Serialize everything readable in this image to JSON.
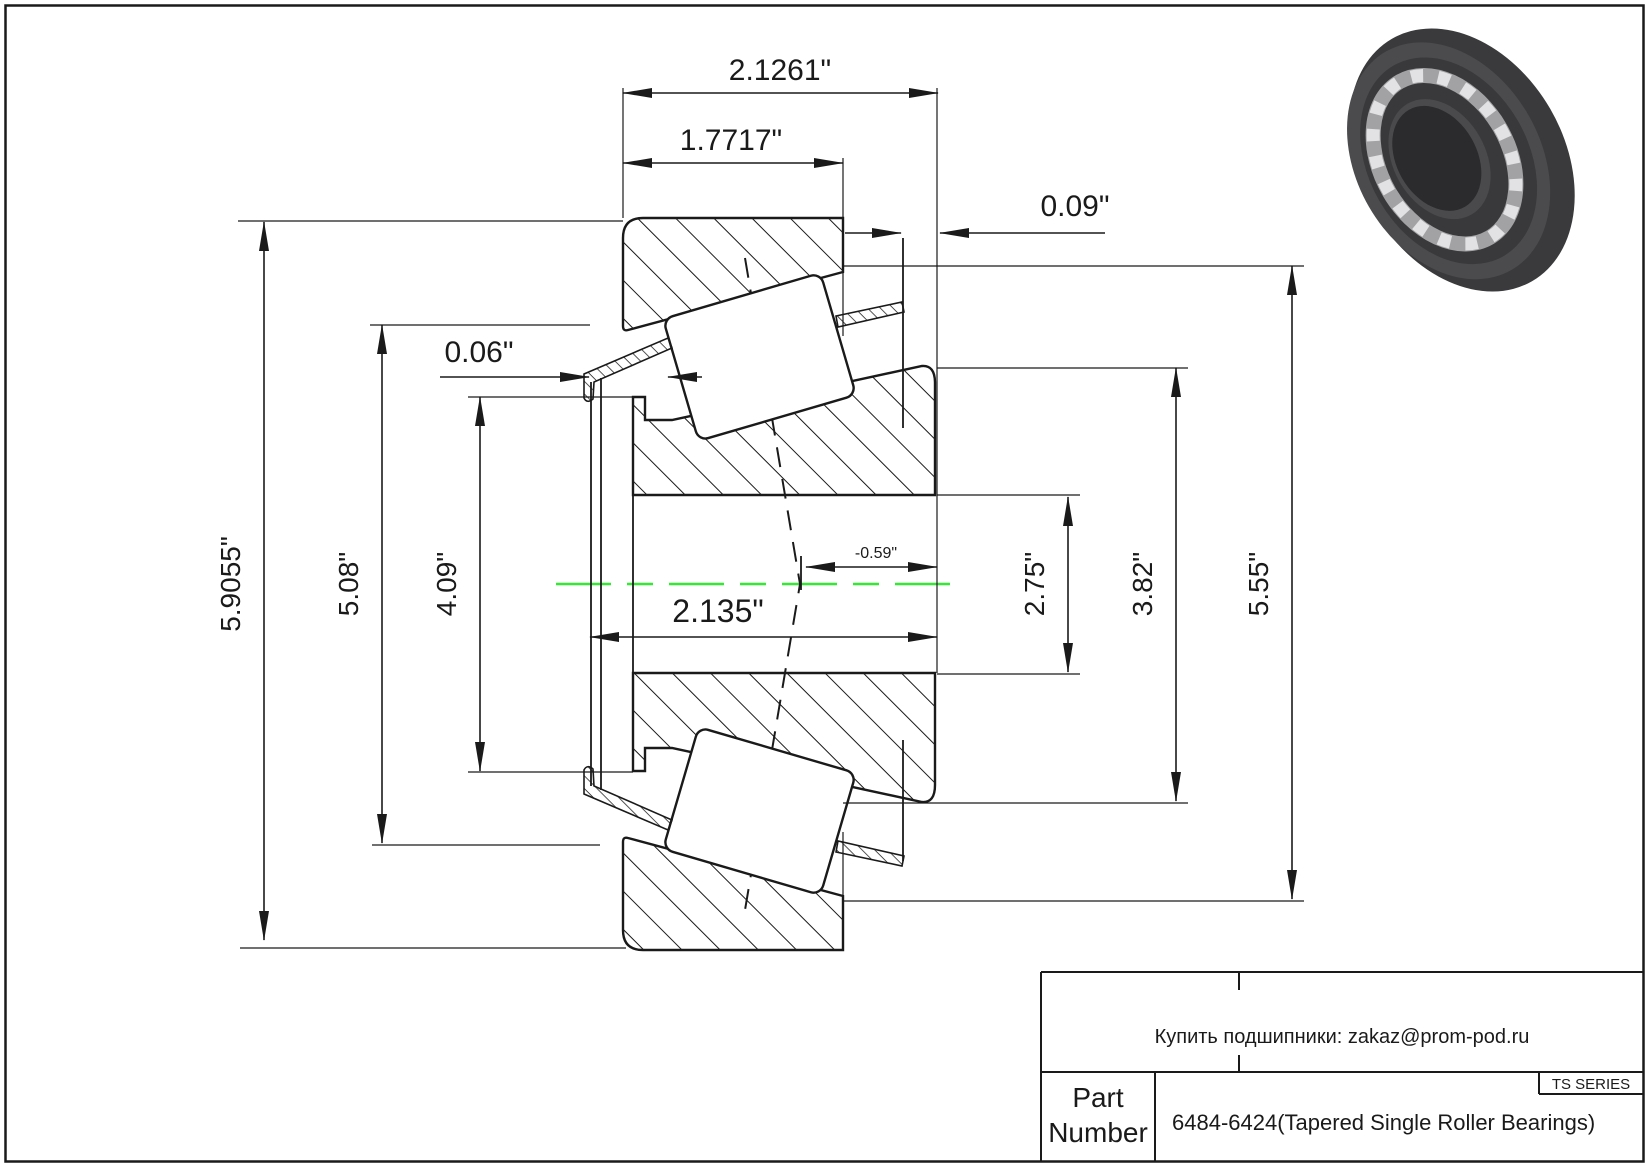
{
  "page": {
    "background": "#ffffff",
    "border_color": "#1a1a1a"
  },
  "colors": {
    "line": "#1a1a1a",
    "center_line_green": "#35e835",
    "bearing_body_dark": "#3a3a3c",
    "bearing_face": "#4b4b4e",
    "bearing_cage": "#a2a2a5",
    "bearing_rollers": "#e2e2e4",
    "bearing_bore": "#2b2b2d"
  },
  "dimensions": {
    "cup_outer_width": "2.1261\"",
    "cone_width": "1.7717\"",
    "back_face_offset": "0.09\"",
    "front_face_offset": "0.06\"",
    "outer_diameter": "5.9055\"",
    "flange_diameter": "5.08\"",
    "front_rib_diameter": "4.09\"",
    "overall_width": "2.135\"",
    "effective_center": "-0.59\"",
    "bore_diameter": "2.75\"",
    "cone_back_diameter": "3.82\"",
    "cup_inner_diameter": "5.55\""
  },
  "title_block": {
    "contact_line": "Купить подшипники: zakaz@prom-pod.ru",
    "series_badge": "TS SERIES",
    "part_label_line1": "Part",
    "part_label_line2": "Number",
    "part_number": "6484-6424(Tapered Single Roller Bearings)"
  }
}
